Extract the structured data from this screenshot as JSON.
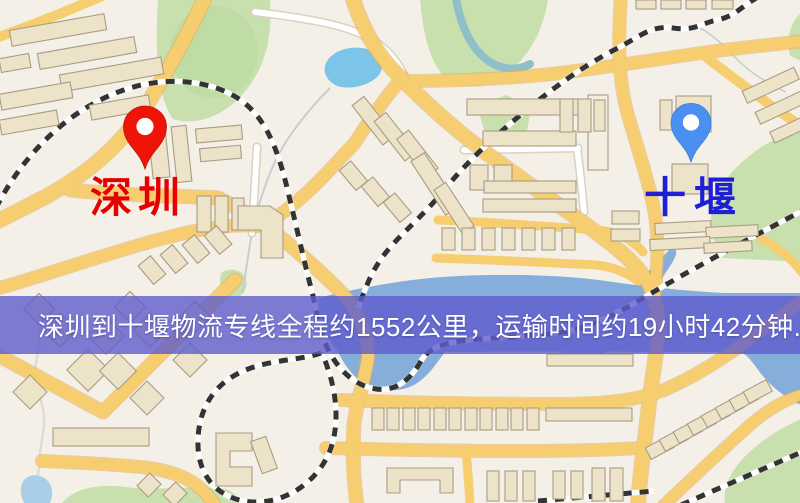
{
  "banner": {
    "text": "深圳到十堰物流专线全程约1552公里，运输时间约19小时42分钟.",
    "background_color": "#5F5DCD",
    "opacity": "0.8",
    "text_color": "#FFFFFF"
  },
  "route": {
    "origin": "深圳",
    "destination": "十堰",
    "distance_km": "1552",
    "duration": "19小时42分钟"
  },
  "markers": {
    "origin": {
      "label": "深圳",
      "label_color": "#E60000",
      "pin_color": "#EE1508",
      "pin_icon": "red-map-pin"
    },
    "destination": {
      "label": "十堰",
      "label_color": "#1F1FD6",
      "pin_color": "#4A90F0",
      "pin_icon": "blue-map-pin"
    }
  },
  "map": {
    "colors": {
      "background": "#F4F0E7",
      "road": "#F7CE6F",
      "road_casing": "#E5AF58",
      "park": "#C8E0AE",
      "water": "#85AEDB",
      "lake": "#7CC4E8",
      "building_fill": "#EDE3C9",
      "building_outline": "#A89C84",
      "railway_dark": "#333333",
      "railway_light": "#FDFDFD"
    }
  }
}
